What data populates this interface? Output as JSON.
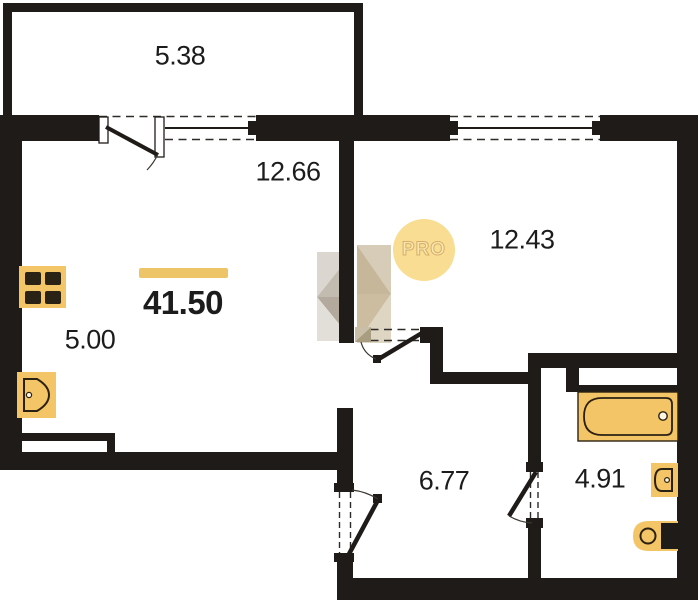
{
  "plan": {
    "badge": "PRO",
    "total": {
      "area": "41.50"
    },
    "rooms": {
      "balcony": "5.38",
      "living": "12.66",
      "bedroom": "12.43",
      "kitchen": "5.00",
      "hall": "6.77",
      "bathroom": "4.91"
    },
    "icons": {
      "stove": "stove-icon",
      "kitchen_sink": "kitchen-sink-icon",
      "bathtub": "bathtub-icon",
      "washbasin": "washbasin-icon",
      "toilet": "toilet-icon"
    },
    "colors": {
      "wall": "#1f1b18",
      "dash": "#2e2b28",
      "fixture": "#f4c566",
      "fixture_outline": "#2b2113",
      "accent_bar": "#eec469",
      "badge_bg": "#f8dd92"
    }
  }
}
